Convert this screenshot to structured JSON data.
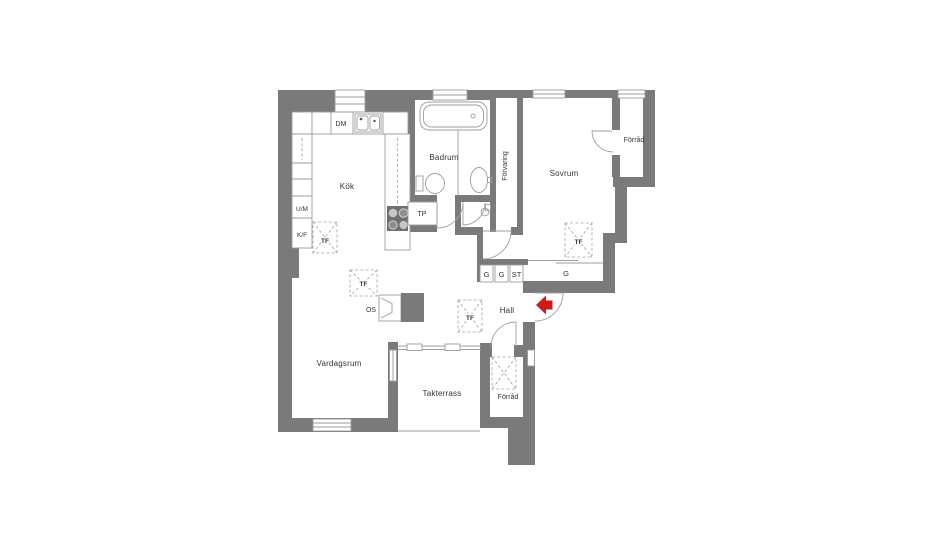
{
  "plan": {
    "colors": {
      "wall": "#7a7a7a",
      "line": "#9c9c9c",
      "text": "#333333",
      "arrow": "#cc1b1b",
      "background": "#ffffff"
    },
    "rooms": {
      "kok": "Kök",
      "badrum": "Badrum",
      "sovrum": "Sovrum",
      "forrad_top": "Förråd",
      "forvaring": "Förvaring",
      "hall": "Hall",
      "vardagsrum": "Vardagsrum",
      "takterrass": "Takterrass",
      "forrad_bottom": "Förråd"
    },
    "markers": {
      "dm": "DM",
      "tp": "TP",
      "um": "U/M",
      "kf": "K/F",
      "os": "OS",
      "tf": "TF",
      "g": "G",
      "st": "ST"
    }
  }
}
